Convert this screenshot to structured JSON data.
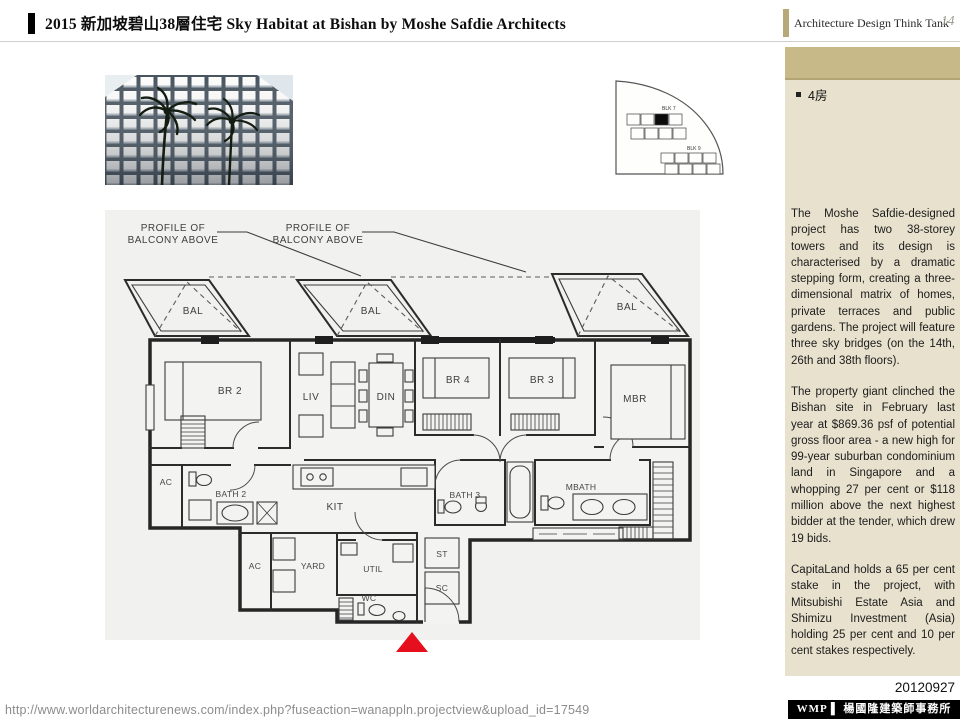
{
  "header": {
    "title": "2015 新加坡碧山38層住宅 Sky Habitat at Bishan by Moshe Safdie Architects",
    "brand": "Architecture Design Think Tank",
    "page_number": "14"
  },
  "sidebar": {
    "bullet": "4房",
    "paragraphs": {
      "p1": "The Moshe Safdie-designed project has two 38-storey towers and its design is characterised by a dramatic stepping form, creating a three-dimensional matrix of homes, private terraces and public gardens. The project will feature three sky bridges (on the 14th, 26th and 38th floors).",
      "p2": "The property giant clinched the Bishan site in February last year at $869.36 psf of potential gross floor area - a new high for 99-year suburban condominium land in Singapore and a whopping 27 per cent or $118 million above the next highest bidder at the tender, which drew 19 bids.",
      "p3": "CapitaLand holds a 65 per cent stake in the project, with Mitsubishi Estate Asia and Shimizu Investment (Asia) holding 25 per cent and 10 per cent stakes respectively."
    },
    "date": "20120927"
  },
  "footer": {
    "url": "http://www.worldarchitecturenews.com/index.php?fuseaction=wanappln.projectview&upload_id=17549",
    "firm": "WMP ▌ 楊國隆建築師事務所"
  },
  "floorplan": {
    "profile_line1": "PROFILE OF",
    "profile_line2": "BALCONY ABOVE",
    "rooms": {
      "bal": "BAL",
      "br2": "BR 2",
      "liv": "LIV",
      "din": "DIN",
      "br4": "BR 4",
      "br3": "BR 3",
      "mbr": "MBR",
      "ac": "AC",
      "bath2": "BATH 2",
      "kit": "KIT",
      "bath3": "BATH 3",
      "mbath": "MBATH",
      "yard": "YARD",
      "util": "UTIL",
      "st": "ST",
      "sc": "SC",
      "wc": "WC"
    }
  },
  "siteplan": {
    "blk7": "BLK 7",
    "blk9": "BLK 9"
  }
}
